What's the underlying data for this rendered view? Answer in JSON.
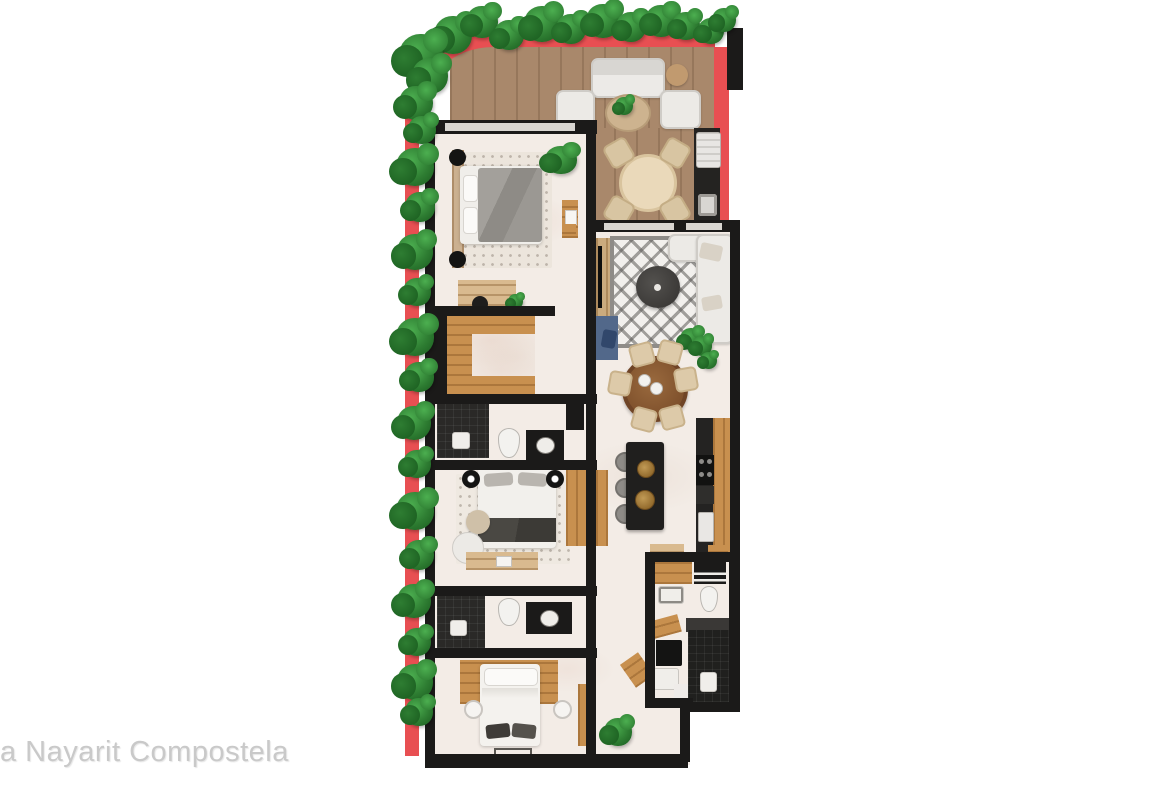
{
  "watermark": "a Nayarit Compostela",
  "palette": {
    "red": "#e84f52",
    "wall": "#1b1a19",
    "deck": "#a9886b",
    "marble": "#f3ece6",
    "wood": "#c8904f",
    "wood-light": "#d9ba8f",
    "dark-tile": "#2a2927",
    "island": "#201f1e",
    "gold": "#c19a55",
    "blue": "#52688a",
    "sofa": "#eceae6",
    "plant-dark": "#1b5e20",
    "plant-mid": "#2e7d32",
    "plant-light": "#4caf50",
    "watermark": "#c9c9c9"
  }
}
